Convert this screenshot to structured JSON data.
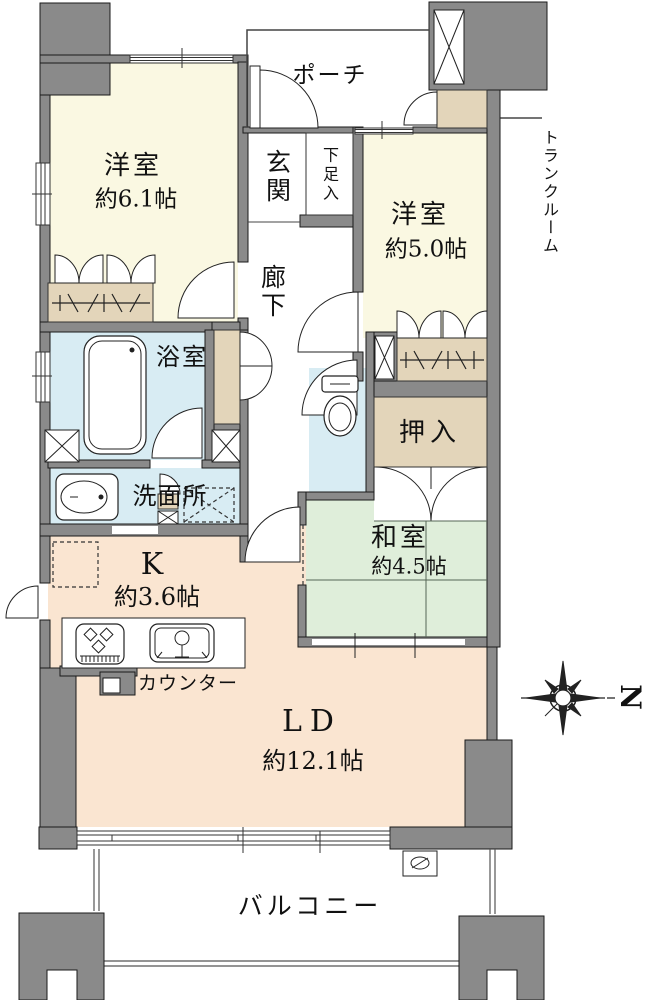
{
  "rooms": {
    "western1": {
      "name": "洋室",
      "size": "約6.1帖"
    },
    "western2": {
      "name": "洋室",
      "size": "約5.0帖"
    },
    "japanese": {
      "name": "和室",
      "size": "約4.5帖"
    },
    "living_dining": {
      "name": "LD",
      "size": "約12.1帖"
    },
    "kitchen": {
      "name": "K",
      "size": "約3.6帖"
    },
    "entrance": {
      "name": "玄関"
    },
    "hallway": {
      "name": "廊下"
    },
    "bathroom": {
      "name": "浴室"
    },
    "washroom": {
      "name": "洗面所"
    },
    "porch": {
      "name": "ポーチ"
    },
    "balcony": {
      "name": "バルコニー"
    }
  },
  "storage": {
    "shoe_cabinet": "下足入",
    "trunk_room": "トランクルーム",
    "oshiire": "押入"
  },
  "kitchen_counter_label": "カウンター",
  "compass": {
    "north": "N"
  },
  "colors": {
    "wall": "#8a8a8a",
    "western_room": "#faf8e2",
    "wet_area": "#d8ecf3",
    "kitchen_living": "#fae5d1",
    "japanese_room": "#dfeeda",
    "storage": "#e3d5ba"
  }
}
